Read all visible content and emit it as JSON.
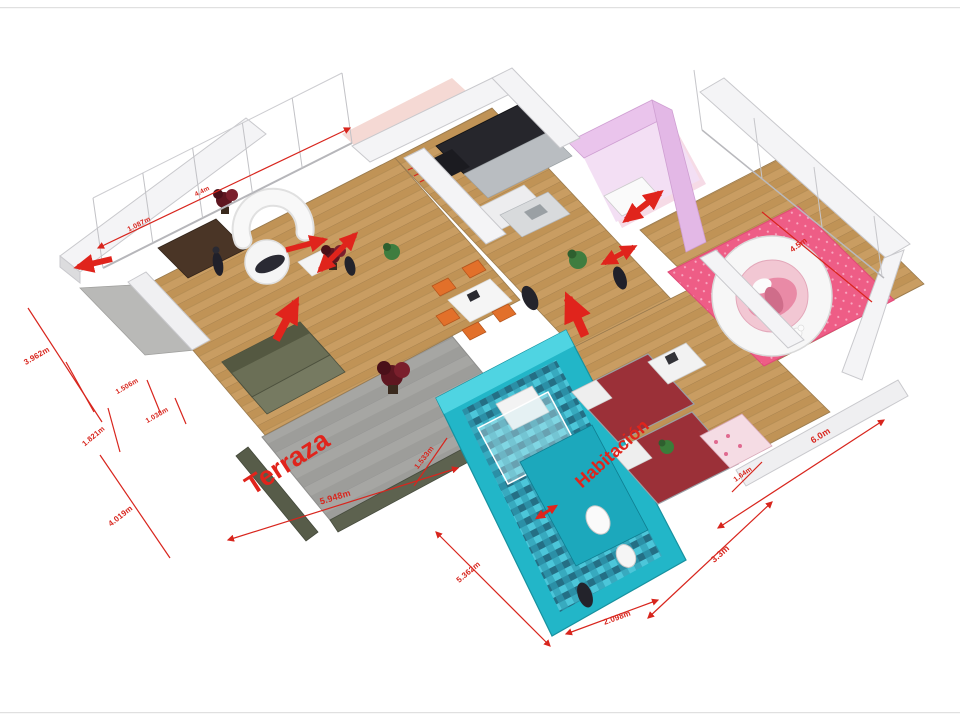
{
  "rooms": {
    "terraza": "Terraza",
    "habitacion": "Habitación"
  },
  "dimensions": [
    {
      "label": "1.087m"
    },
    {
      "label": "4.4m"
    },
    {
      "label": "3.962m"
    },
    {
      "label": "1.506m"
    },
    {
      "label": "1.038m"
    },
    {
      "label": "1.821m"
    },
    {
      "label": "4.019m"
    },
    {
      "label": "5.948m"
    },
    {
      "label": "1.533m"
    },
    {
      "label": "5.362m"
    },
    {
      "label": "2.098m"
    },
    {
      "label": "3.3m"
    },
    {
      "label": "6.0m"
    },
    {
      "label": "4.5m"
    },
    {
      "label": "1.64m"
    }
  ],
  "colors": {
    "dimension_red": "#d8251d",
    "arrow_red": "#e0241c",
    "wood_floor": "#c99d62",
    "terrace_gray": "#a6a6a3",
    "bathroom_teal": "#22b6c8",
    "bedroom_pink": "#ee5d86",
    "closet_lilac": "#eac4ec",
    "kids_bed_red": "#9b3038"
  }
}
